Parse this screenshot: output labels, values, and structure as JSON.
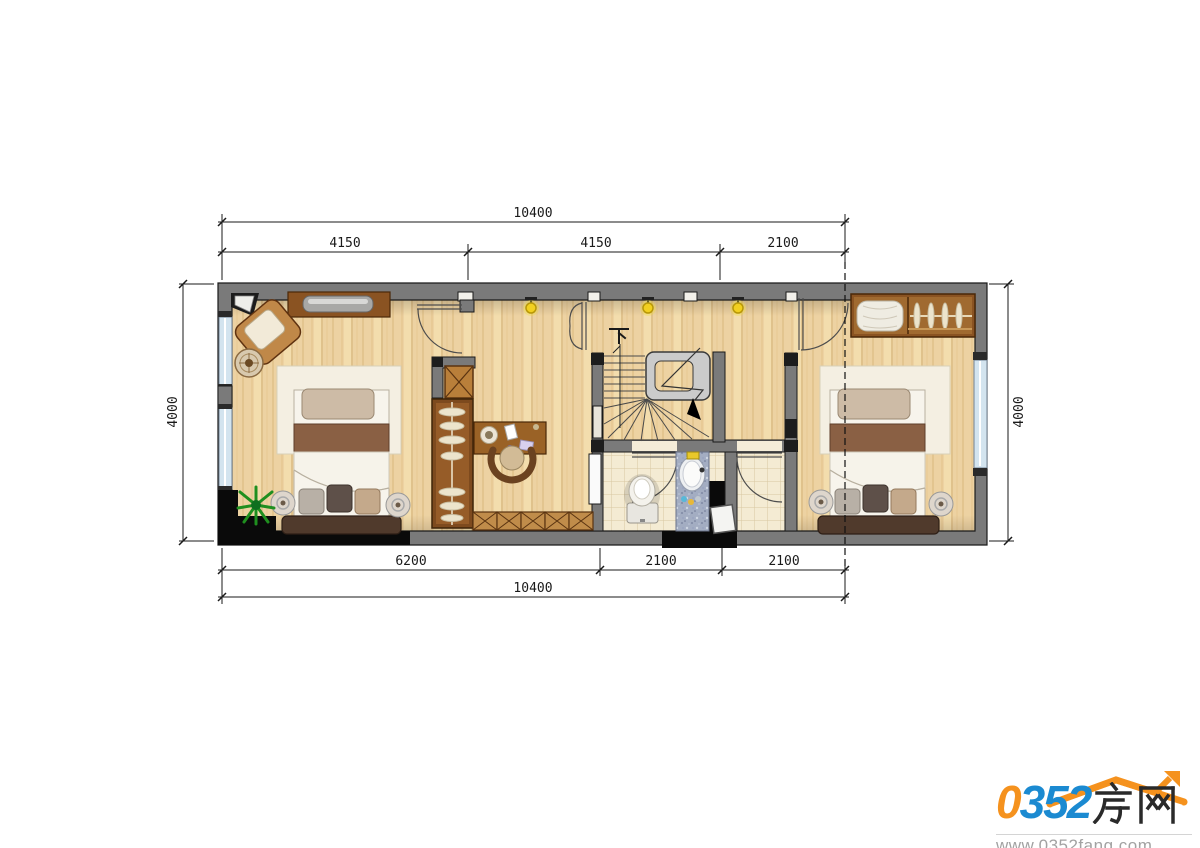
{
  "dimensions": {
    "top": {
      "total": "10400",
      "seg1": "4150",
      "seg2": "4150",
      "seg3": "2100"
    },
    "bottom": {
      "seg1": "6200",
      "seg2": "2100",
      "seg3": "2100",
      "total": "10400"
    },
    "left": "4000",
    "right": "4000"
  },
  "stairs": {
    "direction_label": "下"
  },
  "watermark": {
    "zero": "0",
    "num": "352",
    "cn": "房网",
    "url": "www.0352fang.com"
  },
  "colors": {
    "wall_gray": "#7a7a7a",
    "floor_wood": "#edd2a2",
    "tile_floor": "#f4ebd3",
    "logo_orange": "#f5921e",
    "logo_blue": "#1b8ad1",
    "light_yellow": "#f2d020"
  }
}
